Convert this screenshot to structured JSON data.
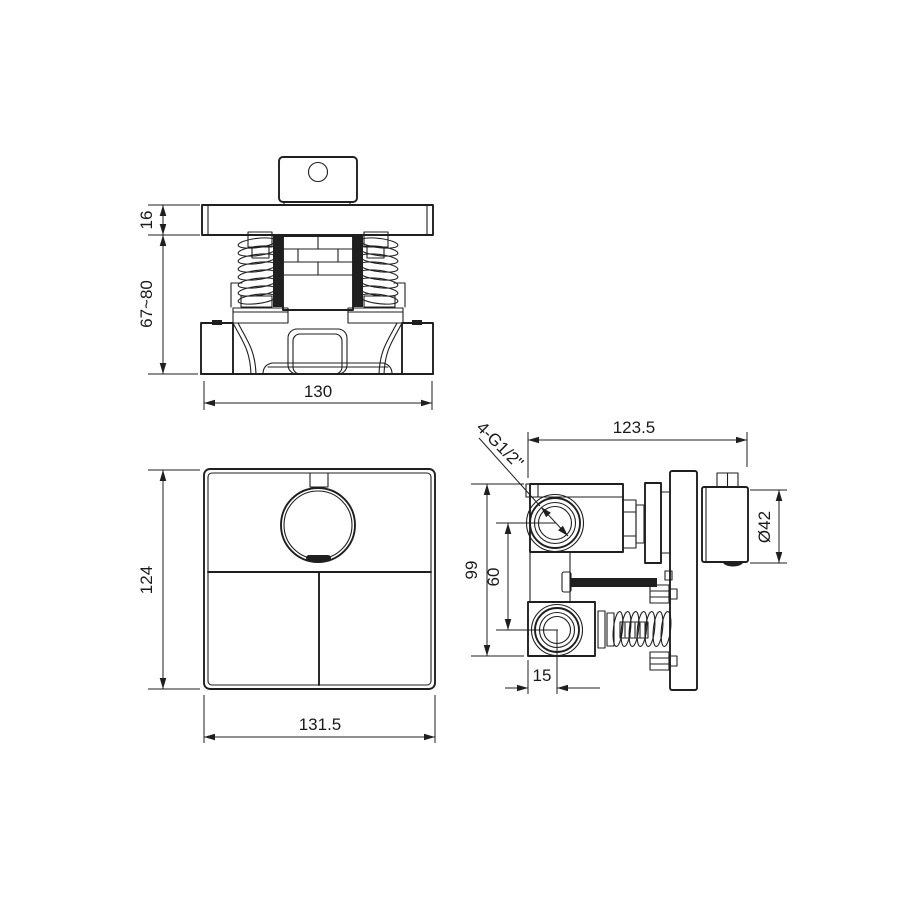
{
  "drawing": {
    "title": "Concealed thermostatic shower valve — dimensional drawing",
    "front": {
      "plate_thickness": "16",
      "height_range": "67~80",
      "body_width": "130"
    },
    "panel": {
      "height": "124",
      "width": "131.5"
    },
    "side": {
      "depth": "123.5",
      "knob_diameter": "Ø42",
      "body_height": "99",
      "port_spacing": "60",
      "port_offset": "15",
      "thread_label": "4-G1/2\""
    },
    "colors": {
      "line": "#1f1f1f",
      "background": "#ffffff"
    }
  }
}
